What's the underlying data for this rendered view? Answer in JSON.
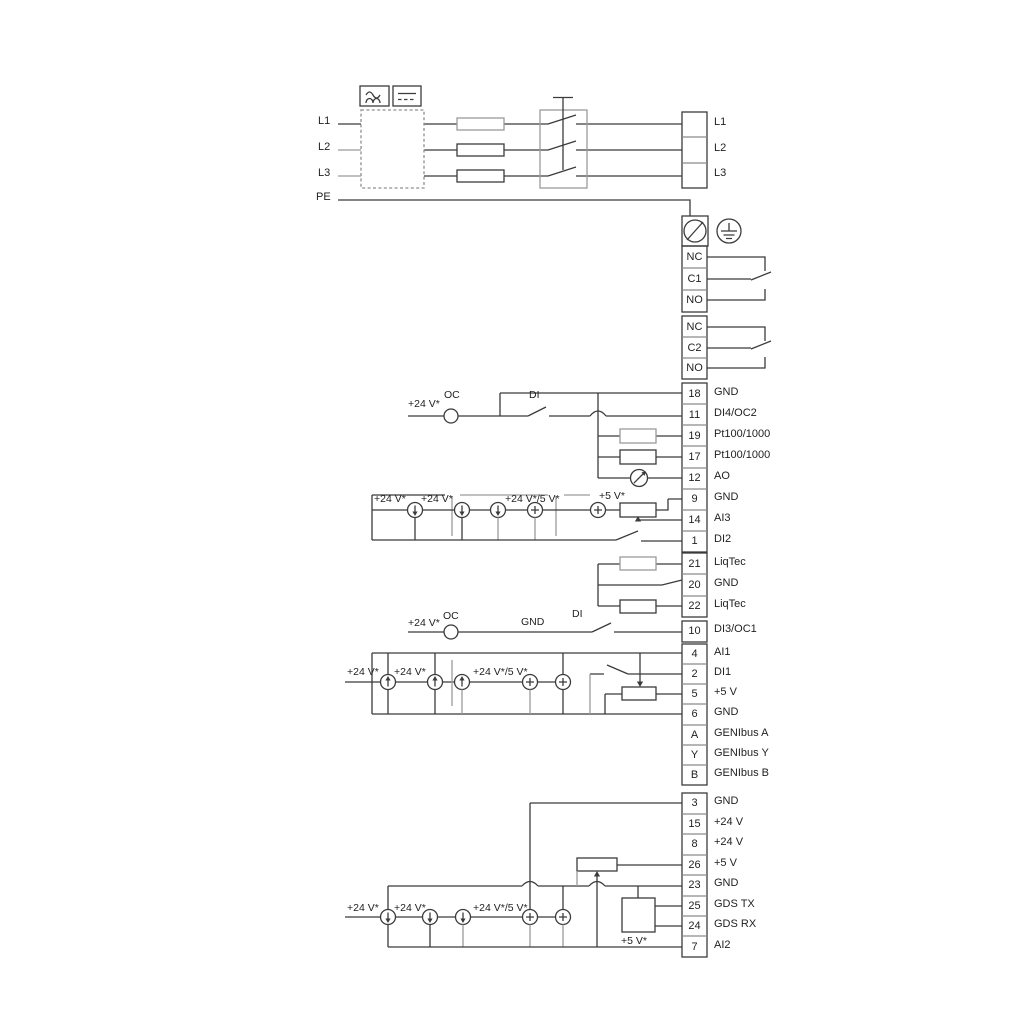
{
  "mains": {
    "inputs": [
      "L1",
      "L2",
      "L3",
      "PE"
    ],
    "outputs": [
      "L1",
      "L2",
      "L3"
    ]
  },
  "relays": {
    "relay1": [
      "NC",
      "C1",
      "NO"
    ],
    "relay2": [
      "NC",
      "C2",
      "NO"
    ]
  },
  "strips": {
    "io_top": [
      {
        "num": "18",
        "label": "GND"
      },
      {
        "num": "11",
        "label": "DI4/OC2"
      },
      {
        "num": "19",
        "label": "Pt100/1000"
      },
      {
        "num": "17",
        "label": "Pt100/1000"
      },
      {
        "num": "12",
        "label": "AO"
      },
      {
        "num": "9",
        "label": "GND"
      },
      {
        "num": "14",
        "label": "AI3"
      },
      {
        "num": "1",
        "label": "DI2"
      }
    ],
    "liqtec": [
      {
        "num": "21",
        "label": "LiqTec"
      },
      {
        "num": "20",
        "label": "GND"
      },
      {
        "num": "22",
        "label": "LiqTec"
      }
    ],
    "di3": [
      {
        "num": "10",
        "label": "DI3/OC1"
      }
    ],
    "io_mid": [
      {
        "num": "4",
        "label": "AI1"
      },
      {
        "num": "2",
        "label": "DI1"
      },
      {
        "num": "5",
        "label": "+5 V"
      },
      {
        "num": "6",
        "label": "GND"
      },
      {
        "num": "A",
        "label": "GENIbus A"
      },
      {
        "num": "Y",
        "label": "GENIbus Y"
      },
      {
        "num": "B",
        "label": "GENIbus B"
      }
    ],
    "io_bottom": [
      {
        "num": "3",
        "label": "GND"
      },
      {
        "num": "15",
        "label": "+24 V"
      },
      {
        "num": "8",
        "label": "+24 V"
      },
      {
        "num": "26",
        "label": "+5 V"
      },
      {
        "num": "23",
        "label": "GND"
      },
      {
        "num": "25",
        "label": "GDS TX"
      },
      {
        "num": "24",
        "label": "GDS RX"
      },
      {
        "num": "7",
        "label": "AI2"
      }
    ]
  },
  "notes": {
    "row11": {
      "v24": "+24 V*",
      "oc": "OC",
      "di": "DI"
    },
    "ai3": {
      "v24a": "+24 V*",
      "v24b": "+24 V*",
      "v245": "+24 V*/5 V*",
      "v5": "+5 V*"
    },
    "row10": {
      "v24": "+24 V*",
      "oc": "OC",
      "gnd": "GND",
      "di": "DI"
    },
    "ai1": {
      "v24a": "+24 V*",
      "v24b": "+24 V*",
      "v245": "+24 V*/5 V*"
    },
    "ai2": {
      "v24a": "+24 V*",
      "v24b": "+24 V*",
      "v245": "+24 V*/5 V*",
      "v5": "+5 V*"
    }
  },
  "icons": {
    "ac_symbol": "sine-wave",
    "dc_symbol": "solid-dashed-line",
    "earth": "protective-earth",
    "pe_screw": "screw-terminal",
    "fuse": "fuse",
    "disconnect": "three-pole-switch",
    "current_source": "circle-arrow",
    "voltage_source": "circle-plus",
    "potentiometer": "potentiometer",
    "analog_out": "meter"
  }
}
